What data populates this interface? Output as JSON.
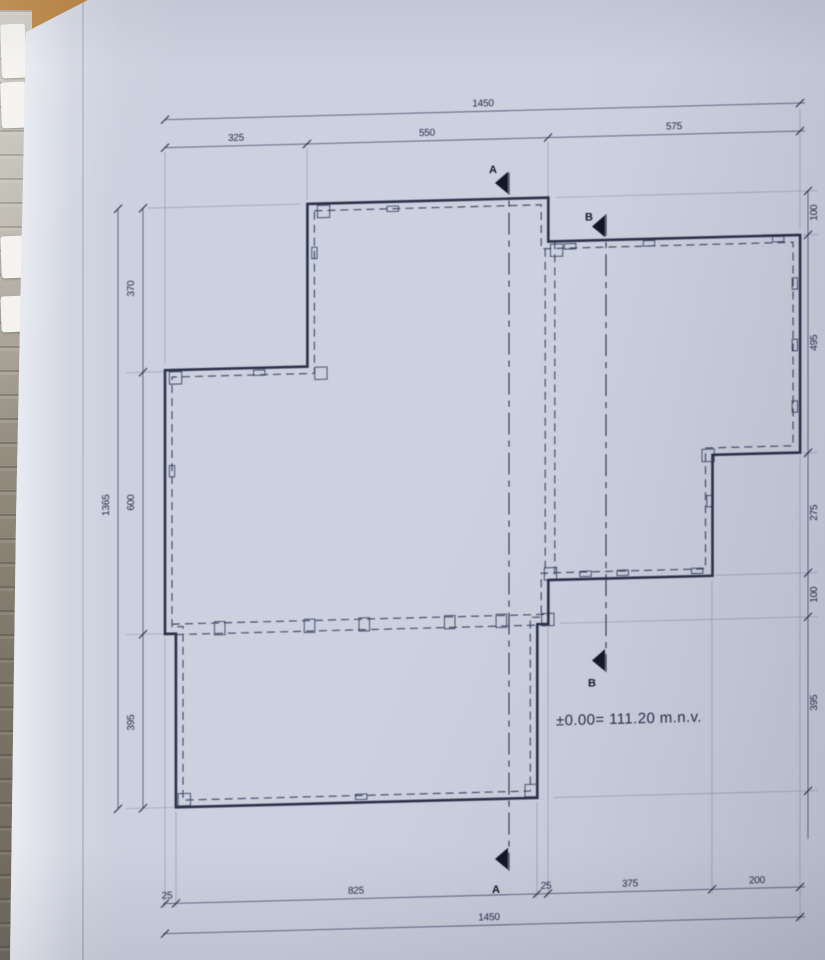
{
  "scene": {
    "desk_color": "#b5792e",
    "paper_color": "#ccd1df",
    "page_stack": {
      "tab_color": "#f3f2ee",
      "tabs": [
        [
          14,
          54
        ],
        [
          72,
          46
        ],
        [
          226,
          42
        ],
        [
          286,
          36
        ]
      ]
    }
  },
  "drawing": {
    "level_text": "±0.00= 111.20 m.n.v.",
    "ink": {
      "outline": "#343a52",
      "dashed": "#49516e",
      "dim": "#6a7088",
      "ext": "#7d84a0",
      "text": "#2d3450",
      "marker": "#161b2c"
    },
    "skew_deg": -1.5,
    "scale": {
      "ox": 165,
      "oy": 212,
      "sx": 0.438,
      "sy": 0.4395
    },
    "outline": [
      [
        325,
        0
      ],
      [
        875,
        0
      ],
      [
        875,
        100
      ],
      [
        1450,
        100
      ],
      [
        1450,
        595
      ],
      [
        1250,
        595
      ],
      [
        1250,
        870
      ],
      [
        875,
        870
      ],
      [
        875,
        970
      ],
      [
        850,
        970
      ],
      [
        850,
        1365
      ],
      [
        25,
        1365
      ],
      [
        25,
        970
      ],
      [
        0,
        970
      ],
      [
        0,
        370
      ],
      [
        325,
        370
      ]
    ],
    "offset_inset": 16,
    "partitions": [
      {
        "u1": 868,
        "v1": 116,
        "u2": 868,
        "v2": 858
      },
      {
        "u1": 890,
        "v1": 100,
        "u2": 890,
        "v2": 870
      },
      {
        "u1": 16,
        "v1": 948,
        "u2": 872,
        "v2": 948
      },
      {
        "u1": 25,
        "v1": 972,
        "u2": 848,
        "v2": 972
      }
    ],
    "wall_ticks": [
      {
        "u": 215,
        "v": 381,
        "w": 26,
        "h": 12
      },
      {
        "u": 520,
        "v": 16,
        "w": 26,
        "h": 12
      },
      {
        "u": 341,
        "v": 112,
        "w": 12,
        "h": 26
      },
      {
        "u": 925,
        "v": 112,
        "w": 26,
        "h": 12
      },
      {
        "u": 1105,
        "v": 110,
        "w": 26,
        "h": 12
      },
      {
        "u": 1400,
        "v": 108,
        "w": 26,
        "h": 12
      },
      {
        "u": 1438,
        "v": 210,
        "w": 12,
        "h": 26
      },
      {
        "u": 1438,
        "v": 350,
        "w": 12,
        "h": 26
      },
      {
        "u": 1438,
        "v": 490,
        "w": 12,
        "h": 26
      },
      {
        "u": 1243,
        "v": 700,
        "w": 12,
        "h": 26
      },
      {
        "u": 960,
        "v": 858,
        "w": 26,
        "h": 12
      },
      {
        "u": 1045,
        "v": 858,
        "w": 26,
        "h": 12
      },
      {
        "u": 1215,
        "v": 858,
        "w": 26,
        "h": 12
      },
      {
        "u": 125,
        "v": 960,
        "w": 24,
        "h": 30
      },
      {
        "u": 330,
        "v": 960,
        "w": 24,
        "h": 30
      },
      {
        "u": 455,
        "v": 960,
        "w": 24,
        "h": 30
      },
      {
        "u": 650,
        "v": 960,
        "w": 24,
        "h": 30
      },
      {
        "u": 768,
        "v": 960,
        "w": 24,
        "h": 30
      },
      {
        "u": 448,
        "v": 1352,
        "w": 26,
        "h": 12
      },
      {
        "u": 16,
        "v": 600,
        "w": 12,
        "h": 26
      }
    ],
    "corner_boxes": {
      "size": 28,
      "at": [
        [
          348,
          4
        ],
        [
          10,
          374
        ],
        [
          342,
          372
        ],
        [
          880,
          106
        ],
        [
          866,
          842
        ],
        [
          1226,
          582
        ],
        [
          30,
          1334
        ],
        [
          822,
          1334
        ],
        [
          860,
          946
        ]
      ]
    },
    "dim_lines": [
      {
        "o": "h",
        "side": "top-total",
        "c": 124,
        "a": 165,
        "b": 805,
        "ticks": [
          165,
          800
        ],
        "labels": [
          {
            "t": "1450",
            "p": 483
          }
        ]
      },
      {
        "o": "h",
        "side": "top-segments",
        "c": 152,
        "a": 165,
        "b": 805,
        "ticks": [
          165,
          307,
          548,
          800
        ],
        "labels": [
          {
            "t": "325",
            "p": 236
          },
          {
            "t": "550",
            "p": 427
          },
          {
            "t": "575",
            "p": 674
          }
        ]
      },
      {
        "o": "h",
        "side": "bottom-segments",
        "c": 908,
        "a": 163,
        "b": 805,
        "ticks": [
          165,
          176,
          537,
          548,
          712,
          800
        ],
        "labels": [
          {
            "t": "25",
            "p": 167
          },
          {
            "t": "825",
            "p": 356
          },
          {
            "t": "25",
            "p": 546
          },
          {
            "t": "375",
            "p": 630
          },
          {
            "t": "200",
            "p": 757
          }
        ]
      },
      {
        "o": "h",
        "side": "bottom-total",
        "c": 938,
        "a": 163,
        "b": 805,
        "ticks": [
          165,
          800
        ],
        "labels": [
          {
            "t": "1450",
            "p": 489
          }
        ]
      },
      {
        "o": "v",
        "side": "left-total",
        "c": 118,
        "a": 212,
        "b": 812,
        "ticks": [
          212,
          812
        ],
        "labels": [
          {
            "t": "1365",
            "p": 508
          }
        ],
        "lside": -1
      },
      {
        "o": "v",
        "side": "left-segments",
        "c": 143,
        "a": 212,
        "b": 812,
        "ticks": [
          212,
          376,
          638,
          812
        ],
        "labels": [
          {
            "t": "370",
            "p": 292
          },
          {
            "t": "600",
            "p": 506
          },
          {
            "t": "395",
            "p": 726
          }
        ],
        "lside": -1
      },
      {
        "o": "v",
        "side": "right-segments",
        "c": 808,
        "a": 212,
        "b": 860,
        "ticks": [
          212,
          256,
          474,
          594,
          638,
          812
        ],
        "labels": [
          {
            "t": "100",
            "p": 234
          },
          {
            "t": "495",
            "p": 364
          },
          {
            "t": "275",
            "p": 534
          },
          {
            "t": "100",
            "p": 616
          },
          {
            "t": "395",
            "p": 724
          }
        ],
        "lside": 1
      }
    ],
    "extension_lines": [
      {
        "x1": 165,
        "y1": 156,
        "x2": 165,
        "y2": 368
      },
      {
        "x1": 307,
        "y1": 156,
        "x2": 307,
        "y2": 208
      },
      {
        "x1": 548,
        "y1": 156,
        "x2": 548,
        "y2": 250
      },
      {
        "x1": 800,
        "y1": 130,
        "x2": 800,
        "y2": 250
      },
      {
        "x1": 165,
        "y1": 642,
        "x2": 165,
        "y2": 912
      },
      {
        "x1": 176,
        "y1": 816,
        "x2": 176,
        "y2": 912
      },
      {
        "x1": 537,
        "y1": 816,
        "x2": 537,
        "y2": 912
      },
      {
        "x1": 548,
        "y1": 642,
        "x2": 548,
        "y2": 912
      },
      {
        "x1": 712,
        "y1": 600,
        "x2": 712,
        "y2": 912
      },
      {
        "x1": 800,
        "y1": 478,
        "x2": 800,
        "y2": 942
      },
      {
        "x1": 148,
        "y1": 212,
        "x2": 300,
        "y2": 212
      },
      {
        "x1": 126,
        "y1": 376,
        "x2": 163,
        "y2": 376
      },
      {
        "x1": 126,
        "y1": 638,
        "x2": 174,
        "y2": 638
      },
      {
        "x1": 126,
        "y1": 812,
        "x2": 174,
        "y2": 812
      },
      {
        "x1": 556,
        "y1": 212,
        "x2": 818,
        "y2": 212
      },
      {
        "x1": 803,
        "y1": 256,
        "x2": 818,
        "y2": 256
      },
      {
        "x1": 803,
        "y1": 474,
        "x2": 818,
        "y2": 474
      },
      {
        "x1": 716,
        "y1": 594,
        "x2": 818,
        "y2": 594
      },
      {
        "x1": 560,
        "y1": 638,
        "x2": 818,
        "y2": 638
      },
      {
        "x1": 554,
        "y1": 812,
        "x2": 818,
        "y2": 812
      }
    ],
    "sections": [
      {
        "name": "A",
        "x": 509,
        "y1": 186,
        "y2": 884,
        "markers": [
          {
            "ty": 196,
            "lx": 489,
            "ly": 186
          },
          {
            "ty": 872,
            "lx": 492,
            "ly": 906
          }
        ]
      },
      {
        "name": "B",
        "x": 606,
        "y1": 230,
        "y2": 688,
        "markers": [
          {
            "ty": 242,
            "lx": 585,
            "ly": 236
          },
          {
            "ty": 676,
            "lx": 588,
            "ly": 702
          }
        ]
      }
    ],
    "level_pos": {
      "x": 556,
      "y": 740
    }
  }
}
